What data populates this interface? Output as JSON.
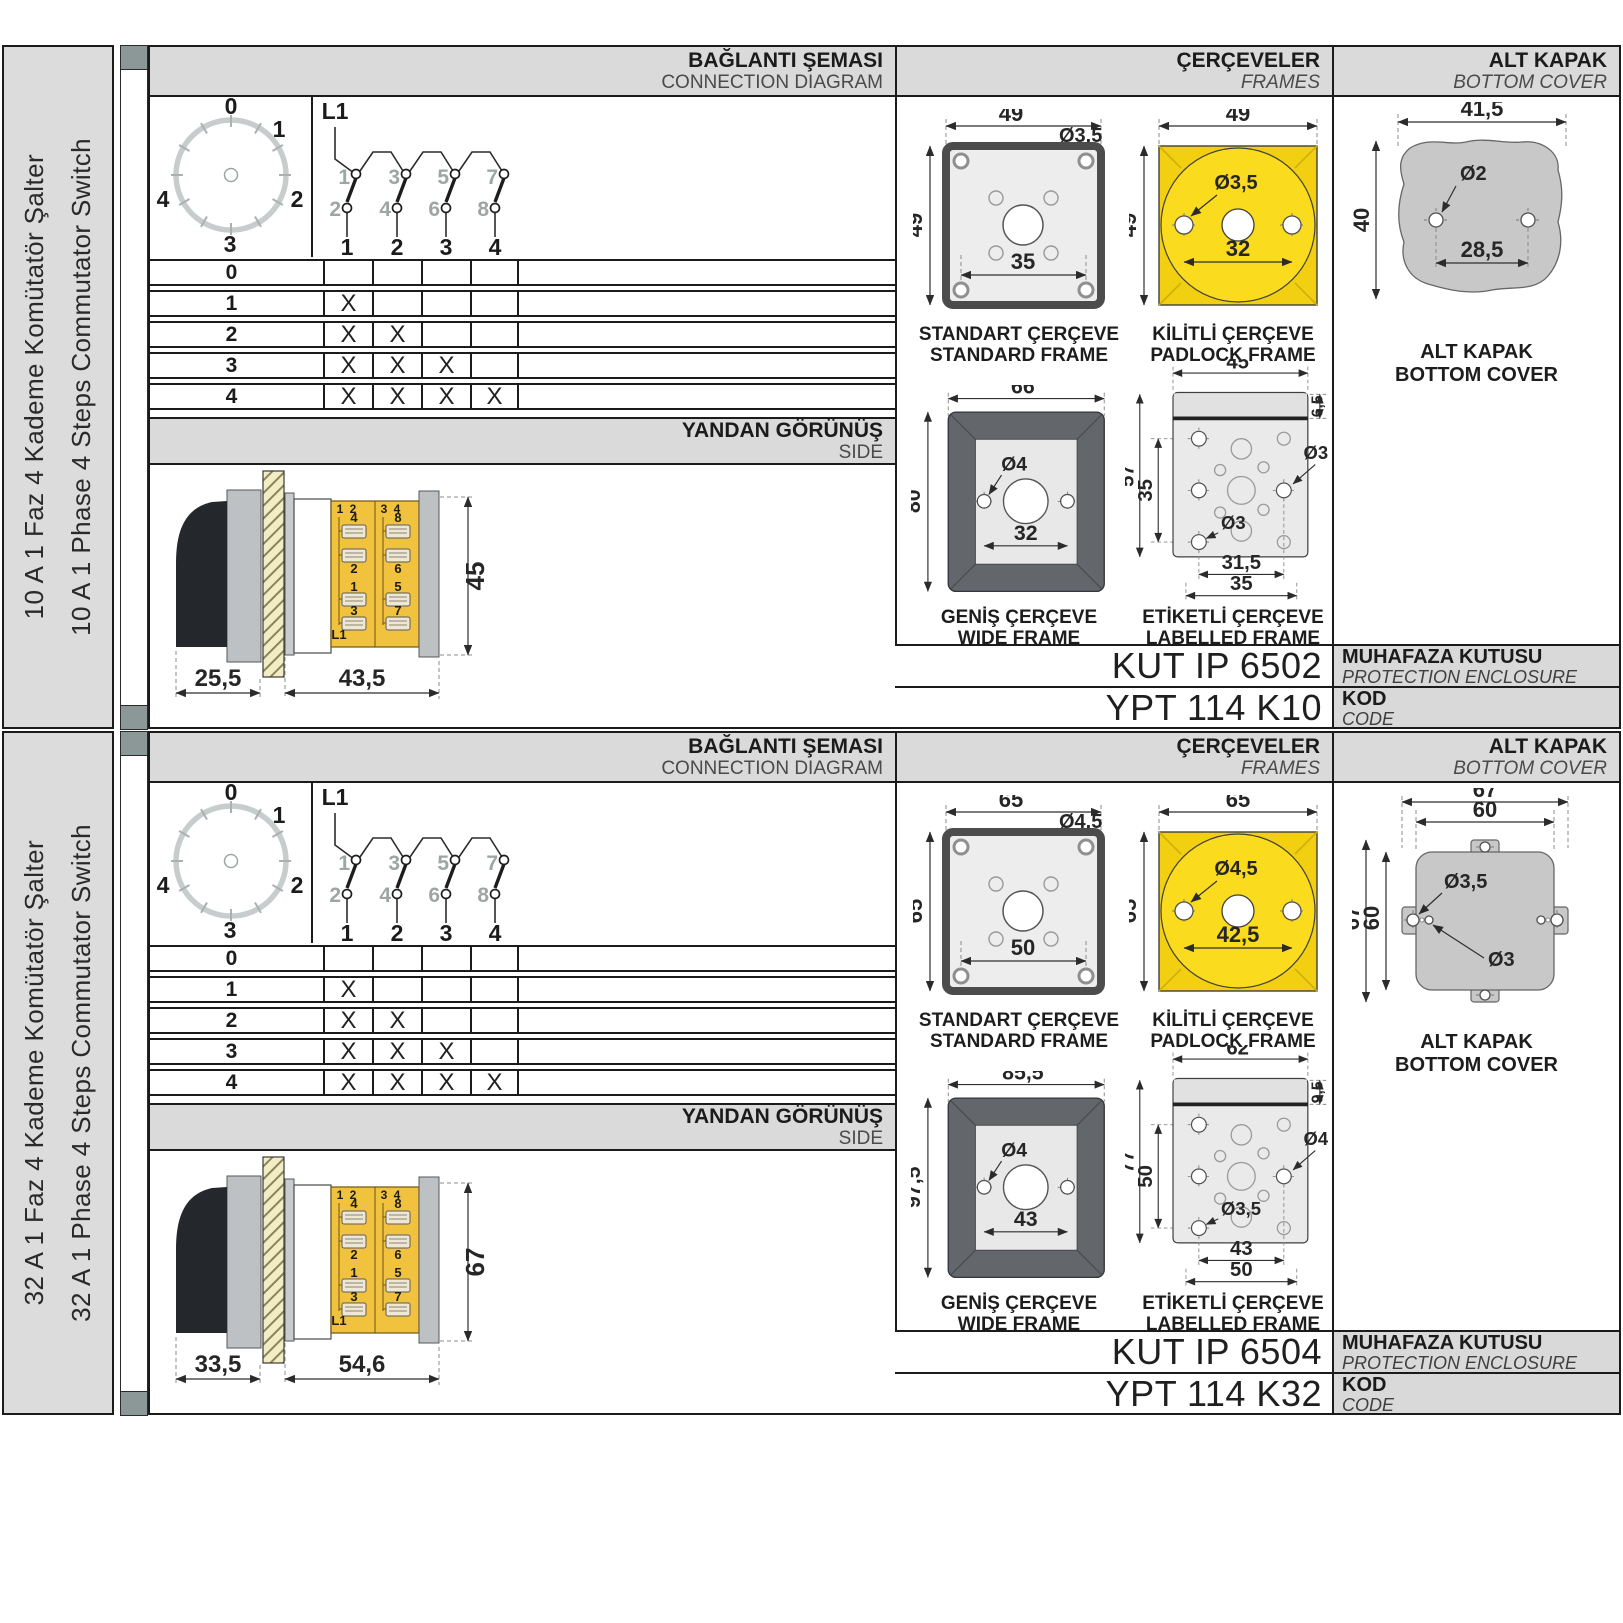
{
  "colors": {
    "panel_header_bg": "#DADADA",
    "sidebar_bg": "#DCDCDC",
    "strip_cap": "#8C9898",
    "yellow_frame": "#F3CF11",
    "yellow_circle": "#FBDB1D",
    "yellow_terminal_block": "#F1C23D",
    "cover_gray": "#C8C8C8",
    "wide_frame_dark": "#63676C",
    "hatch_cream": "#F3EDC6"
  },
  "sections": [
    {
      "sidebar": {
        "title_tr": "10 A 1 Faz 4 Kademe Komütatör Şalter",
        "title_en": "10 A 1 Phase 4 Steps Commutator Switch"
      },
      "connection": {
        "title_tr": "BAĞLANTI ŞEMASI",
        "title_en": "CONNECTION DIAGRAM",
        "dial_positions": [
          "0",
          "1",
          "2",
          "3",
          "4"
        ],
        "line_label": "L1",
        "contacts_top": [
          "1",
          "3",
          "5",
          "7"
        ],
        "contacts_bottom": [
          "2",
          "4",
          "6",
          "8"
        ],
        "outputs": [
          "1",
          "2",
          "3",
          "4"
        ],
        "table_rows": [
          {
            "label": "0",
            "marks": [
              "",
              "",
              "",
              ""
            ]
          },
          {
            "label": "1",
            "marks": [
              "X",
              "",
              "",
              ""
            ]
          },
          {
            "label": "2",
            "marks": [
              "X",
              "X",
              "",
              ""
            ]
          },
          {
            "label": "3",
            "marks": [
              "X",
              "X",
              "X",
              ""
            ]
          },
          {
            "label": "4",
            "marks": [
              "X",
              "X",
              "X",
              "X"
            ]
          }
        ]
      },
      "side_view": {
        "title_tr": "YANDAN GÖRÜNÜŞ",
        "title_en": "SIDE",
        "dim_front": "25,5",
        "dim_body": "43,5",
        "dim_height": "45",
        "pole_labels": [
          "1",
          "2",
          "3",
          "4"
        ],
        "terminals_left": [
          "4",
          "2",
          "1",
          "3"
        ],
        "terminals_right": [
          "8",
          "6",
          "5",
          "7"
        ],
        "input_label": "L1"
      },
      "frames": {
        "title_tr": "ÇERÇEVELER",
        "title_en": "FRAMES",
        "standard": {
          "cap_tr": "STANDART ÇERÇEVE",
          "cap_en": "STANDARD FRAME",
          "dim_w": "49",
          "dim_h": "49",
          "hole": "Ø3,5",
          "spacing": "35"
        },
        "padlock": {
          "cap_tr": "KİLİTLİ ÇERÇEVE",
          "cap_en": "PADLOCK FRAME",
          "dim_w": "49",
          "dim_h": "49",
          "hole": "Ø3,5",
          "spacing": "32"
        },
        "wide": {
          "cap_tr": "GENİŞ ÇERÇEVE",
          "cap_en": "WIDE FRAME",
          "dim_w": "66",
          "dim_h": "80",
          "hole": "Ø4",
          "spacing": "32"
        },
        "labelled": {
          "cap_tr": "ETİKETLİ ÇERÇEVE",
          "cap_en": "LABELLED FRAME",
          "dim_w": "45",
          "dim_h": "57",
          "dim_inner_h": "35",
          "dim_label_h": "6,5",
          "hole_a": "Ø3",
          "hole_b": "Ø3",
          "spacing_a": "31,5",
          "spacing_b": "35"
        }
      },
      "cover": {
        "title_tr": "ALT KAPAK",
        "title_en": "BOTTOM COVER",
        "cap_tr": "ALT KAPAK",
        "cap_en": "BOTTOM COVER",
        "dim_w": "41,5",
        "dim_h": "40",
        "hole": "Ø2",
        "spacing": "28,5"
      },
      "codes": {
        "enclosure": "KUT IP 6502",
        "enclosure_tr": "MUHAFAZA KUTUSU",
        "enclosure_en": "PROTECTION ENCLOSURE",
        "code": "YPT 114 K10",
        "code_tr": "KOD",
        "code_en": "CODE"
      }
    },
    {
      "sidebar": {
        "title_tr": "32 A 1 Faz 4 Kademe Komütatör Şalter",
        "title_en": "32 A 1 Phase 4 Steps Commutator Switch"
      },
      "connection": {
        "title_tr": "BAĞLANTI ŞEMASI",
        "title_en": "CONNECTION DIAGRAM",
        "dial_positions": [
          "0",
          "1",
          "2",
          "3",
          "4"
        ],
        "line_label": "L1",
        "contacts_top": [
          "1",
          "3",
          "5",
          "7"
        ],
        "contacts_bottom": [
          "2",
          "4",
          "6",
          "8"
        ],
        "outputs": [
          "1",
          "2",
          "3",
          "4"
        ],
        "table_rows": [
          {
            "label": "0",
            "marks": [
              "",
              "",
              "",
              ""
            ]
          },
          {
            "label": "1",
            "marks": [
              "X",
              "",
              "",
              ""
            ]
          },
          {
            "label": "2",
            "marks": [
              "X",
              "X",
              "",
              ""
            ]
          },
          {
            "label": "3",
            "marks": [
              "X",
              "X",
              "X",
              ""
            ]
          },
          {
            "label": "4",
            "marks": [
              "X",
              "X",
              "X",
              "X"
            ]
          }
        ]
      },
      "side_view": {
        "title_tr": "YANDAN GÖRÜNÜŞ",
        "title_en": "SIDE",
        "dim_front": "33,5",
        "dim_body": "54,6",
        "dim_height": "67",
        "pole_labels": [
          "1",
          "2",
          "3",
          "4"
        ],
        "terminals_left": [
          "4",
          "2",
          "1",
          "3"
        ],
        "terminals_right": [
          "8",
          "6",
          "5",
          "7"
        ],
        "input_label": "L1"
      },
      "frames": {
        "title_tr": "ÇERÇEVELER",
        "title_en": "FRAMES",
        "standard": {
          "cap_tr": "STANDART ÇERÇEVE",
          "cap_en": "STANDARD FRAME",
          "dim_w": "65",
          "dim_h": "65",
          "hole": "Ø4,5",
          "spacing": "50"
        },
        "padlock": {
          "cap_tr": "KİLİTLİ ÇERÇEVE",
          "cap_en": "PADLOCK FRAME",
          "dim_w": "65",
          "dim_h": "65",
          "hole": "Ø4,5",
          "spacing": "42,5"
        },
        "wide": {
          "cap_tr": "GENİŞ ÇERÇEVE",
          "cap_en": "WIDE FRAME",
          "dim_w": "85,5",
          "dim_h": "97,5",
          "hole": "Ø4",
          "spacing": "43"
        },
        "labelled": {
          "cap_tr": "ETİKETLİ ÇERÇEVE",
          "cap_en": "LABELLED FRAME",
          "dim_w": "62",
          "dim_h": "77",
          "dim_inner_h": "50",
          "dim_label_h": "9,5",
          "hole_a": "Ø4",
          "hole_b": "Ø3,5",
          "spacing_a": "43",
          "spacing_b": "50"
        }
      },
      "cover": {
        "title_tr": "ALT KAPAK",
        "title_en": "BOTTOM COVER",
        "cap_tr": "ALT KAPAK",
        "cap_en": "BOTTOM COVER",
        "dim_w_outer": "67",
        "dim_w_inner": "60",
        "dim_h_outer": "67",
        "dim_h_inner": "60",
        "hole_big": "Ø3,5",
        "hole_small": "Ø3"
      },
      "codes": {
        "enclosure": "KUT IP 6504",
        "enclosure_tr": "MUHAFAZA KUTUSU",
        "enclosure_en": "PROTECTION ENCLOSURE",
        "code": "YPT 114 K32",
        "code_tr": "KOD",
        "code_en": "CODE"
      }
    }
  ]
}
